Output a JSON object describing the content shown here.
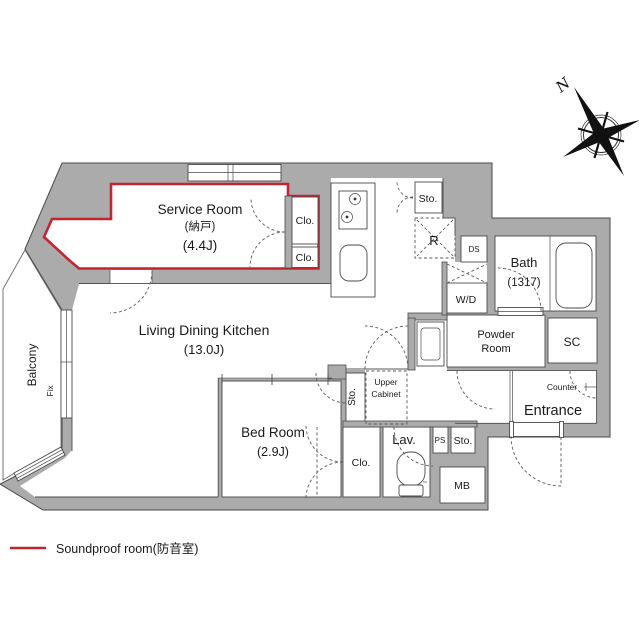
{
  "colors": {
    "soundproof_red": "#c32430",
    "wall_gray": "#ababab",
    "line_dark": "#4a4a4a"
  },
  "rooms": {
    "service_room": {
      "name": "Service Room",
      "name_jp": "(納戸)",
      "area": "(4.4J)"
    },
    "ldk": {
      "name": "Living Dining Kitchen",
      "area": "(13.0J)"
    },
    "bed_room": {
      "name": "Bed Room",
      "area": "(2.9J)"
    },
    "bath": {
      "name": "Bath",
      "size": "(1317)"
    },
    "powder_room": {
      "line1": "Powder",
      "line2": "Room"
    },
    "entrance": {
      "name": "Entrance"
    },
    "balcony": {
      "name": "Balcony"
    },
    "lav": {
      "name": "Lav."
    }
  },
  "fixtures": {
    "closet_abbr": "Clo.",
    "storage_abbr": "Sto.",
    "refrigerator_abbr": "R",
    "duct_space_abbr": "DS",
    "washer_dryer_abbr": "W/D",
    "shoe_closet_abbr": "SC",
    "pipe_space_abbr": "PS",
    "mail_box_abbr": "MB",
    "counter": "Counter",
    "upper_cabinet_line1": "Upper",
    "upper_cabinet_line2": "Cabinet",
    "fixed_window": "Fix"
  },
  "compass": {
    "north": "N"
  },
  "legend": {
    "soundproof": "Soundproof room(防音室)"
  }
}
